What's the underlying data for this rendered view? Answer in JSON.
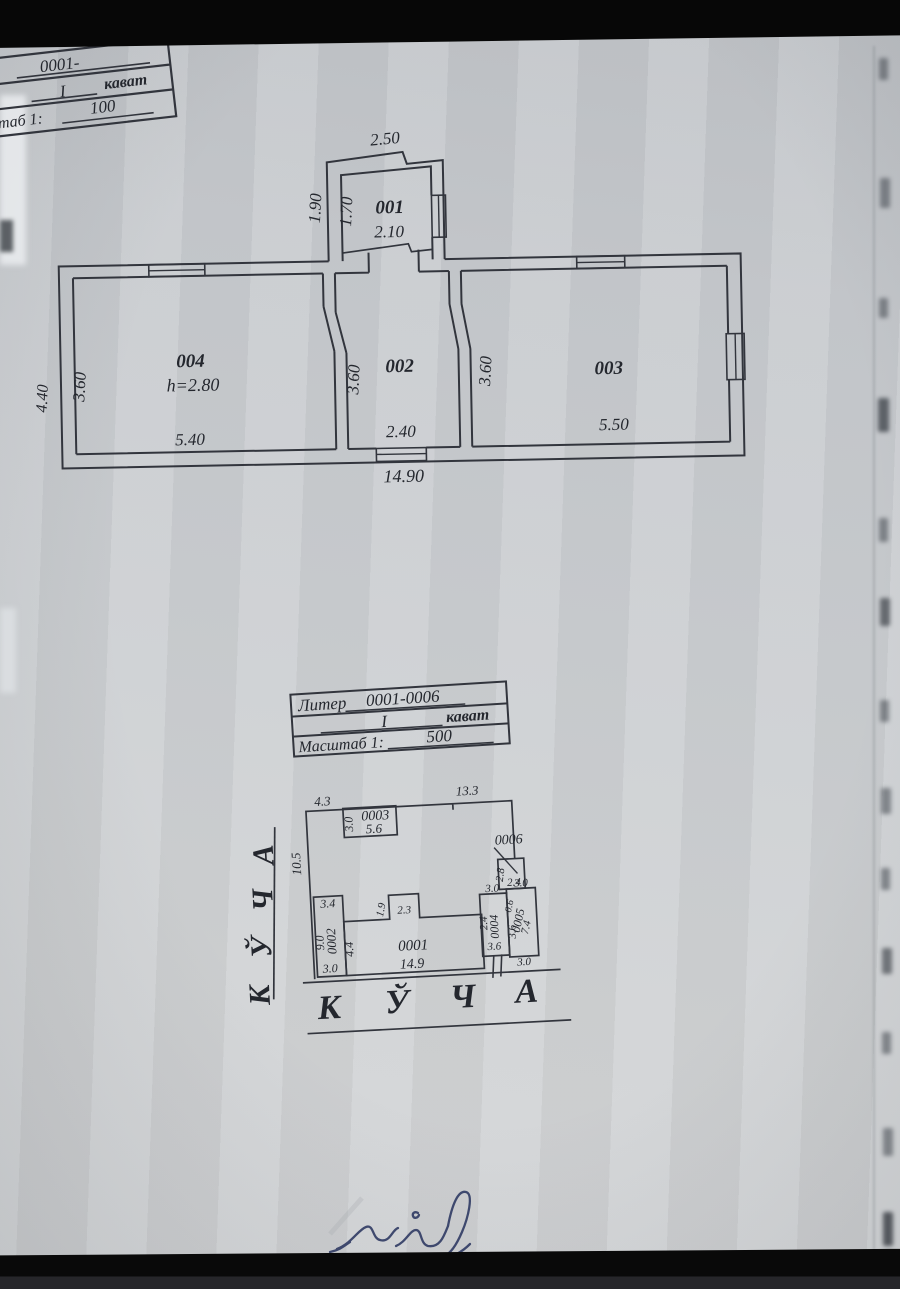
{
  "corner_table": {
    "row1_value": "0001-",
    "row2_value": "I",
    "row2_unit": "кават",
    "row3_label": "таб 1:",
    "row3_value": "100"
  },
  "legend_table": {
    "row1_label": "Литер",
    "row1_value": "0001-0006",
    "row2_value": "I",
    "row2_unit": "кават",
    "row3_label": "Масштаб 1:",
    "row3_value": "500"
  },
  "floor_plan": {
    "room001": {
      "id": "001",
      "dim_top": "2.50",
      "dim_left_outer": "1.90",
      "dim_left_inner": "1.70",
      "dim_bottom": "2.10"
    },
    "room002": {
      "id": "002",
      "dim_left": "3.60",
      "dim_bottom": "2.40"
    },
    "room003": {
      "id": "003",
      "dim_left": "3.60",
      "dim_bottom": "5.50"
    },
    "room004": {
      "id": "004",
      "height": "h=2.80",
      "dim_left": "3.60",
      "dim_outer_left": "4.40",
      "dim_bottom": "5.40"
    },
    "dim_total": "14.90"
  },
  "site_plan": {
    "street_left_letters": [
      "К",
      "Ў",
      "Ч",
      "А"
    ],
    "street_bottom_letters": [
      "К",
      "Ў",
      "Ч",
      "А"
    ],
    "dim_top_left": "4.3",
    "dim_top_right": "13.3",
    "dim_left": "10.5",
    "b0003": {
      "id": "0003",
      "dim_w": "3.0",
      "dim_l": "5.6"
    },
    "b0006": {
      "id": "0006",
      "dim_w": "2.8",
      "dim_l": "2.4"
    },
    "b0002": {
      "id": "0002",
      "dim_top": "3.4",
      "dim_left": "9.0",
      "dim_bottom": "3.0"
    },
    "b0001": {
      "id": "0001",
      "dim_left": "4.4",
      "dim_bump_h": "1.9",
      "dim_bump_w": "2.3",
      "dim_bottom": "14.9"
    },
    "gate_dim": "3.6",
    "b0004": {
      "id": "0004",
      "dim_top": "3.0",
      "dim_left": "2.4",
      "dim_side": "3.6"
    },
    "b0005": {
      "id": "0005",
      "dim_top": "3.0",
      "dim_a": "0.6",
      "dim_b": "7.4",
      "dim_bottom": "3.0"
    }
  }
}
